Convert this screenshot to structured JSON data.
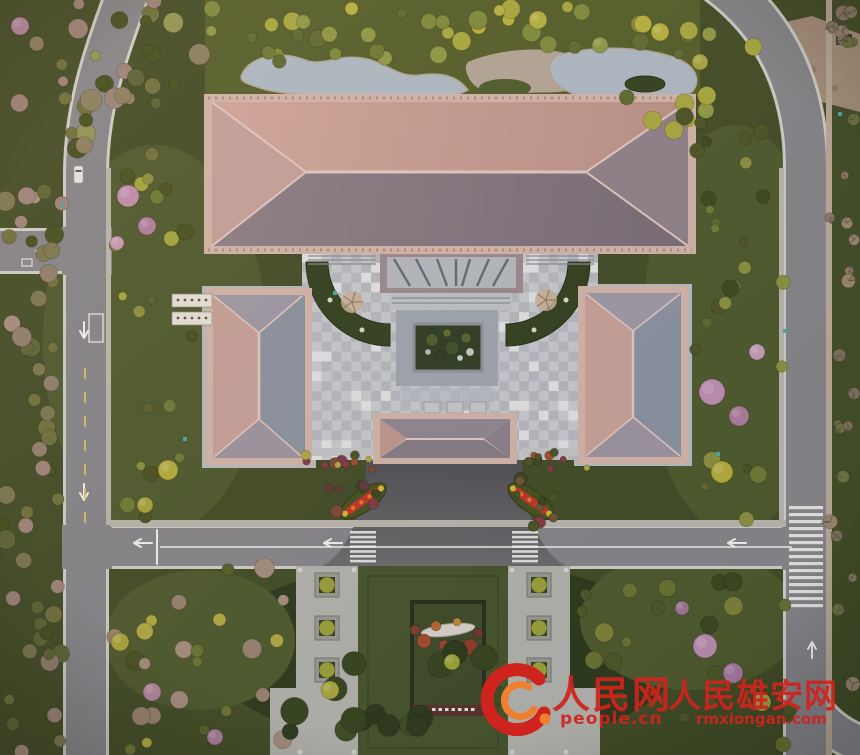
{
  "watermark": {
    "brand1": "人民网",
    "separator": "·",
    "brand2": "人民雄安网",
    "domain1": "people.cn",
    "domain2": "rmxiongan.com"
  },
  "palette": {
    "lawn": "#414d26",
    "lawnLight": "#4d5a2d",
    "lawnOlive": "#535f2a",
    "shadowGreen": "#2c3a1c",
    "water": "#aebbc6",
    "gravel": "#b3a797",
    "dirt": "#a5907a",
    "asphalt": "#85868a",
    "curb": "#cfcfc8",
    "sidewalk": "#b9b7ae",
    "curbTan": "#b9ab97",
    "roadWhite": "#f2f2ee",
    "laneYellow": "#d9c25e",
    "driveTop": "#4f5054",
    "driveBot": "#6a6b6e",
    "eave": "#d3b6aa",
    "roofNorth": "#c9a094",
    "roofSouth": "#7f747c",
    "hipLight": "#c4a29c",
    "hipDark": "#8e828a",
    "ridge": "#e2cac2",
    "wingPink": "#c7a29a",
    "wingBlue": "#8a93a1",
    "wingTriTop": "#9d9aa6",
    "wingTriBot": "#9c95a0",
    "gateTop": "#8f8792",
    "gateBot": "#857d88",
    "gateHipL": "#bd9890",
    "gateHipR": "#8b828b",
    "paveLight": "#b7bcc0",
    "paveMid": "#b4bac0",
    "checkA": "#b6bac0",
    "checkB": "#c7cbd0",
    "checkWhite": "#e2e4e6",
    "bedGreen": "#31411f",
    "frameStone": "#9fa7b0",
    "gardenDark": "#2e3d24",
    "plazaPave": "#b2b3ad",
    "planterFrame": "#9a9b94",
    "planterSoil": "#374524",
    "monLawn": "#46542d",
    "monInner": "#3e4c28",
    "monBorder": "#272f1c",
    "inscription": "#57322e",
    "stoneWhite": "#d8d5cc",
    "wmRed": "#cf241e",
    "wmOrange": "#ef8030",
    "teal": "#4aa9a2"
  },
  "courtyard": {
    "x": 302,
    "y": 253,
    "cols": 30,
    "rows": 21,
    "width": 296,
    "height": 207,
    "whiteRatio": 0.15,
    "seed": 7
  },
  "clusters": [
    {
      "name": "top-left-forest",
      "x": 0,
      "y": 0,
      "w": 205,
      "h": 158,
      "count": 34,
      "rmin": 5,
      "rmax": 11,
      "seed": 11,
      "palette": [
        "#6e713c",
        "#596335",
        "#8b8160",
        "#44501f",
        "#8f9655",
        "#9c8579"
      ]
    },
    {
      "name": "top-band",
      "x": 210,
      "y": 6,
      "w": 480,
      "h": 58,
      "count": 40,
      "rmin": 5,
      "rmax": 10,
      "seed": 22,
      "palette": [
        "#a8a93f",
        "#b7b43f",
        "#7e8b3b",
        "#5d6b2f",
        "#8f9a45",
        "#6d7a33"
      ]
    },
    {
      "name": "top-right-inner",
      "x": 615,
      "y": 18,
      "w": 165,
      "h": 125,
      "count": 15,
      "rmin": 5,
      "rmax": 10,
      "seed": 33,
      "palette": [
        "#8f9a45",
        "#5d6b2f",
        "#a8a93f",
        "#4c5525"
      ]
    },
    {
      "name": "left-forest",
      "x": 0,
      "y": 152,
      "w": 62,
      "h": 600,
      "count": 52,
      "rmin": 5,
      "rmax": 10,
      "seed": 44,
      "palette": [
        "#5d6535",
        "#6e713c",
        "#8f7f6d",
        "#9c8579",
        "#44501f",
        "#7a7850",
        "#a58e7d"
      ]
    },
    {
      "name": "inner-left-garden",
      "x": 110,
      "y": 168,
      "w": 92,
      "h": 350,
      "count": 20,
      "rmin": 4,
      "rmax": 9,
      "seed": 55,
      "palette": [
        "#59612f",
        "#6e7b35",
        "#a4a73e",
        "#48521f",
        "#8a9140"
      ]
    },
    {
      "name": "inner-right-garden",
      "x": 693,
      "y": 140,
      "w": 92,
      "h": 380,
      "count": 24,
      "rmin": 4,
      "rmax": 9,
      "seed": 66,
      "palette": [
        "#4c5525",
        "#5d6a2e",
        "#6e7b35",
        "#3c4a1e",
        "#8a9140"
      ]
    },
    {
      "name": "right-strip",
      "x": 828,
      "y": 0,
      "w": 32,
      "h": 755,
      "count": 26,
      "rmin": 4,
      "rmax": 8,
      "seed": 77,
      "bare": true,
      "palette": [
        "#8a7a64",
        "#97866e",
        "#7b6f5c",
        "#6b7340"
      ]
    },
    {
      "name": "bottom-left-inner",
      "x": 112,
      "y": 568,
      "w": 180,
      "h": 185,
      "count": 24,
      "rmin": 5,
      "rmax": 10,
      "seed": 88,
      "palette": [
        "#55602c",
        "#6c7434",
        "#96836f",
        "#a58e7d",
        "#475222",
        "#b0a943"
      ]
    },
    {
      "name": "bottom-center-dark",
      "x": 290,
      "y": 635,
      "w": 215,
      "h": 118,
      "count": 16,
      "rmin": 8,
      "rmax": 14,
      "seed": 99,
      "palette": [
        "#2c3a1c",
        "#35451f",
        "#3e4e24"
      ]
    },
    {
      "name": "bottom-right-inner",
      "x": 575,
      "y": 570,
      "w": 215,
      "h": 183,
      "count": 22,
      "rmin": 5,
      "rmax": 10,
      "seed": 111,
      "palette": [
        "#3a4820",
        "#4c5828",
        "#697234",
        "#7c8138"
      ]
    },
    {
      "name": "driveway-shrubs-left",
      "x": 328,
      "y": 458,
      "w": 48,
      "h": 70,
      "count": 10,
      "rmin": 3,
      "rmax": 7,
      "seed": 122,
      "palette": [
        "#5f3a36",
        "#7c4736",
        "#485426",
        "#394620",
        "#6d5430",
        "#803c44"
      ]
    },
    {
      "name": "driveway-shrubs-right",
      "x": 512,
      "y": 458,
      "w": 48,
      "h": 70,
      "count": 10,
      "rmin": 3,
      "rmax": 7,
      "seed": 133,
      "palette": [
        "#5f3a36",
        "#7c4736",
        "#485426",
        "#394620",
        "#6d5430",
        "#803c44"
      ]
    },
    {
      "name": "south-bed-left",
      "x": 302,
      "y": 452,
      "w": 72,
      "h": 18,
      "count": 8,
      "rmin": 3,
      "rmax": 5,
      "seed": 144,
      "palette": [
        "#803c44",
        "#b0a943",
        "#485426",
        "#a14e2c"
      ]
    },
    {
      "name": "south-bed-right",
      "x": 522,
      "y": 452,
      "w": 74,
      "h": 18,
      "count": 8,
      "rmin": 3,
      "rmax": 5,
      "seed": 155,
      "palette": [
        "#803c44",
        "#b0a943",
        "#485426",
        "#a14e2c"
      ]
    }
  ],
  "accentTrees": [
    {
      "x": 128,
      "y": 196,
      "r": 11,
      "color": "#c08fae"
    },
    {
      "x": 147,
      "y": 226,
      "r": 9,
      "color": "#b27fa0"
    },
    {
      "x": 117,
      "y": 243,
      "r": 7,
      "color": "#c79bb4"
    },
    {
      "x": 20,
      "y": 26,
      "r": 9,
      "color": "#b88aa6"
    },
    {
      "x": 712,
      "y": 392,
      "r": 13,
      "color": "#bd8fb2"
    },
    {
      "x": 739,
      "y": 416,
      "r": 10,
      "color": "#ab7d9e"
    },
    {
      "x": 757,
      "y": 352,
      "r": 8,
      "color": "#c49eb6"
    },
    {
      "x": 705,
      "y": 646,
      "r": 12,
      "color": "#b98cae"
    },
    {
      "x": 733,
      "y": 673,
      "r": 10,
      "color": "#a87ba0"
    },
    {
      "x": 152,
      "y": 692,
      "r": 9,
      "color": "#b588a2"
    },
    {
      "x": 215,
      "y": 737,
      "r": 8,
      "color": "#a87e9a"
    },
    {
      "x": 682,
      "y": 608,
      "r": 7,
      "color": "#9e7894"
    },
    {
      "x": 168,
      "y": 470,
      "r": 10,
      "color": "#b2ad3b"
    },
    {
      "x": 145,
      "y": 505,
      "r": 8,
      "color": "#a8a43c"
    },
    {
      "x": 722,
      "y": 472,
      "r": 11,
      "color": "#b2ad3b"
    },
    {
      "x": 660,
      "y": 32,
      "r": 9,
      "color": "#b7b43f"
    },
    {
      "x": 700,
      "y": 62,
      "r": 8,
      "color": "#a8a93f"
    },
    {
      "x": 330,
      "y": 690,
      "r": 9,
      "color": "#a7a83c"
    },
    {
      "x": 452,
      "y": 662,
      "r": 8,
      "color": "#9aa338"
    },
    {
      "x": 120,
      "y": 642,
      "r": 9,
      "color": "#aaa63e"
    },
    {
      "x": 762,
      "y": 702,
      "r": 9,
      "color": "#a3a43c"
    },
    {
      "x": 538,
      "y": 20,
      "r": 9,
      "color": "#b4b13e"
    },
    {
      "x": 600,
      "y": 45,
      "r": 8,
      "color": "#8f9a45"
    }
  ],
  "bareCourtyardTrees": [
    {
      "x": 352,
      "y": 302,
      "r": 11
    },
    {
      "x": 546,
      "y": 300,
      "r": 11
    }
  ],
  "gardenShrubs": [
    {
      "x": 432,
      "y": 340,
      "r": 6,
      "color": "#4c6030"
    },
    {
      "x": 452,
      "y": 348,
      "r": 7,
      "color": "#3c5028"
    },
    {
      "x": 466,
      "y": 338,
      "r": 5,
      "color": "#56642f"
    },
    {
      "x": 440,
      "y": 355,
      "r": 4,
      "color": "#2f3e1f"
    },
    {
      "x": 460,
      "y": 358,
      "r": 3,
      "color": "#cfd2cc"
    },
    {
      "x": 470,
      "y": 352,
      "r": 4,
      "color": "#c8ccc6"
    },
    {
      "x": 428,
      "y": 352,
      "r": 3,
      "color": "#b7bcb6"
    },
    {
      "x": 447,
      "y": 333,
      "r": 4,
      "color": "#5e6a33"
    }
  ],
  "monumentShrubs": [
    {
      "x": 424,
      "y": 641,
      "r": 7,
      "color": "#a14e2c"
    },
    {
      "x": 470,
      "y": 647,
      "r": 8,
      "color": "#8c3c2a"
    },
    {
      "x": 436,
      "y": 626,
      "r": 5,
      "color": "#b56a30"
    },
    {
      "x": 457,
      "y": 622,
      "r": 4,
      "color": "#c08a36"
    },
    {
      "x": 415,
      "y": 630,
      "r": 5,
      "color": "#7c4030"
    },
    {
      "x": 478,
      "y": 633,
      "r": 5,
      "color": "#6d3828"
    },
    {
      "x": 444,
      "y": 645,
      "r": 5,
      "color": "#94462c"
    }
  ],
  "plazaPlanters": [
    {
      "x": 315,
      "y": 573
    },
    {
      "x": 315,
      "y": 616
    },
    {
      "x": 315,
      "y": 658
    },
    {
      "x": 527,
      "y": 573
    },
    {
      "x": 527,
      "y": 616
    },
    {
      "x": 527,
      "y": 658
    }
  ],
  "tealMarkers": [
    {
      "x": 838,
      "y": 112
    },
    {
      "x": 783,
      "y": 329
    },
    {
      "x": 716,
      "y": 452
    },
    {
      "x": 60,
      "y": 203
    },
    {
      "x": 183,
      "y": 437
    },
    {
      "x": 333,
      "y": 291
    }
  ],
  "inscriptionMarkCount": 9
}
